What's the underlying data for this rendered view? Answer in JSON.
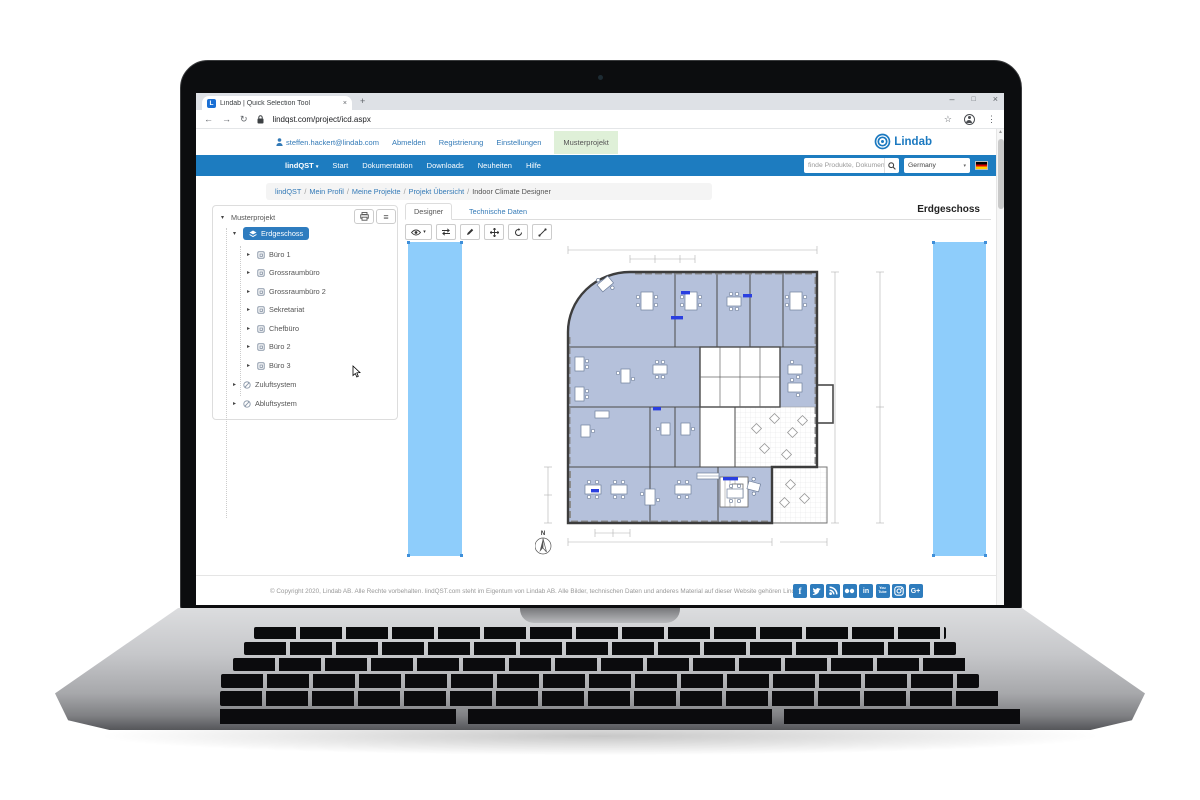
{
  "browser": {
    "tab_title": "Lindab | Quick Selection Tool",
    "url": "lindqst.com/project/icd.aspx",
    "icons": {
      "back": "←",
      "forward": "→",
      "reload": "↻",
      "new_tab": "+",
      "tab_close": "×",
      "minimize": "–",
      "maximize": "□",
      "close": "×",
      "bookmark": "☆",
      "menu": "⋮",
      "scroll_up": "▲"
    }
  },
  "header": {
    "user_email": "steffen.hackert@lindab.com",
    "logout": "Abmelden",
    "register": "Registrierung",
    "settings": "Einstellungen",
    "active_project": "Musterprojekt",
    "logo_text": "Lindab"
  },
  "navbar": {
    "brand": "lindQST",
    "brand_caret": "▾",
    "items": [
      "Start",
      "Dokumentation",
      "Downloads",
      "Neuheiten",
      "Hilfe"
    ],
    "search_placeholder": "finde Produkte, Dokumenta",
    "country": "Germany",
    "select_caret": "▾"
  },
  "breadcrumb": {
    "links": [
      "lindQST",
      "Mein Profil",
      "Meine Projekte",
      "Projekt Übersicht"
    ],
    "sep": "/",
    "current": "Indoor Climate Designer"
  },
  "tree": {
    "root": "Musterprojekt",
    "selected_floor": "Erdgeschoss",
    "rooms": [
      "Büro 1",
      "Grossraumbüro",
      "Grossraumbüro 2",
      "Sekretariat",
      "Chefbüro",
      "Büro 2",
      "Büro 3"
    ],
    "systems": [
      "Zuluftsystem",
      "Abluftsystem"
    ],
    "caret_open": "▾",
    "caret_closed": "▸",
    "list_button": "≡"
  },
  "designer": {
    "tab_designer": "Designer",
    "tab_technical": "Technische Daten",
    "floor_title": "Erdgeschoss",
    "compass_label": "N",
    "toolbar_icons": [
      "visibility-eye",
      "swap-arrows",
      "edit-pencil",
      "move-cross",
      "rotate-arrow",
      "measure-diagonal"
    ]
  },
  "footer": {
    "copyright": "© Copyright 2020, Lindab AB. Alle Rechte vorbehalten. lindQST.com steht im Eigentum von Lindab AB. Alle Bilder, technischen Daten und anderes Material auf dieser Website gehören Lindab",
    "social": [
      "facebook",
      "twitter",
      "rss",
      "flickr",
      "linkedin",
      "youtube",
      "instagram",
      "google-plus"
    ],
    "linkedin_label": "in",
    "facebook_label": "f",
    "youtube_label_top": "You",
    "youtube_label_bottom": "Tube",
    "gplus_label": "G+"
  },
  "colors": {
    "lindab_blue": "#1d7cc0",
    "link_blue": "#337ab7",
    "selected_node_blue": "#2e7cbf",
    "riser_light_blue": "#8ecdfb",
    "plan_room_fill": "#b5c1db",
    "active_project_bg": "#dff0d8"
  }
}
